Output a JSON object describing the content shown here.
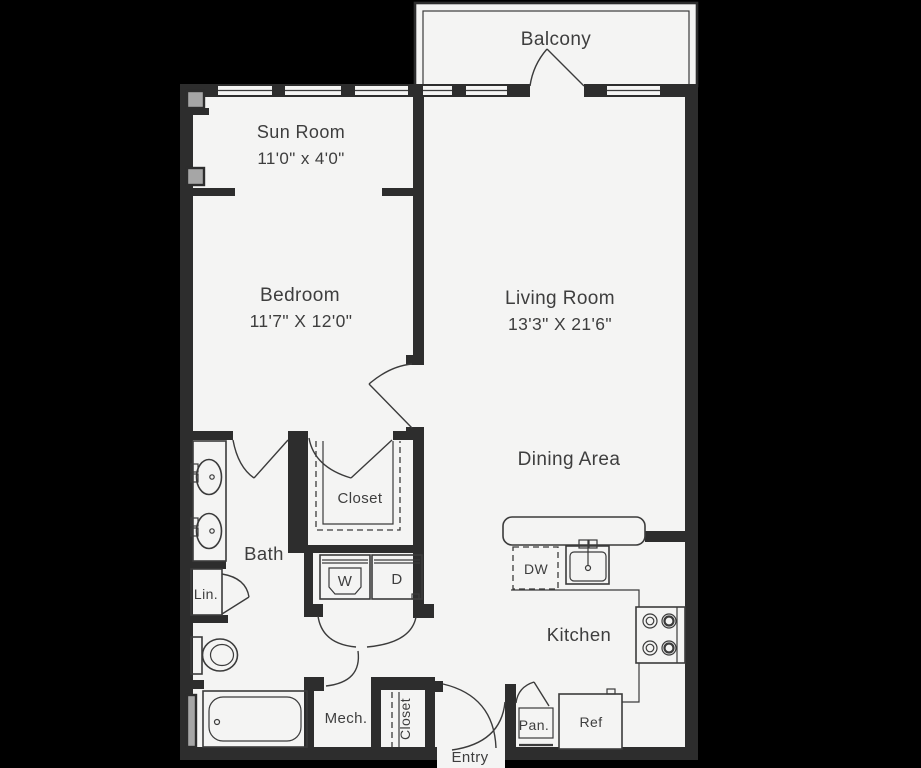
{
  "title": "One-bedroom apartment floor plan",
  "colors": {
    "background": "#000000",
    "floor": "#f4f4f3",
    "wall": "#2d2d2d",
    "line": "#3b3b3b",
    "column_gray": "#a6a6a6",
    "text": "#3e3e3e"
  },
  "rooms": {
    "balcony": {
      "label": "Balcony"
    },
    "sun_room": {
      "label": "Sun Room",
      "dimensions": "11'0\" x 4'0\""
    },
    "bedroom": {
      "label": "Bedroom",
      "dimensions": "11'7\" X 12'0\""
    },
    "living_room": {
      "label": "Living Room",
      "dimensions": "13'3\" X 21'6\""
    },
    "dining_area": {
      "label": "Dining Area"
    },
    "kitchen": {
      "label": "Kitchen"
    },
    "bath": {
      "label": "Bath"
    },
    "closet_main": {
      "label": "Closet"
    },
    "closet_entry": {
      "label": "Closet"
    },
    "linen": {
      "label": "Lin."
    },
    "mechanical": {
      "label": "Mech."
    },
    "pantry": {
      "label": "Pan."
    },
    "entry": {
      "label": "Entry"
    }
  },
  "appliances": {
    "washer": {
      "label": "W"
    },
    "dryer": {
      "label": "D"
    },
    "dishwasher": {
      "label": "DW"
    },
    "refrigerator": {
      "label": "Ref"
    }
  }
}
